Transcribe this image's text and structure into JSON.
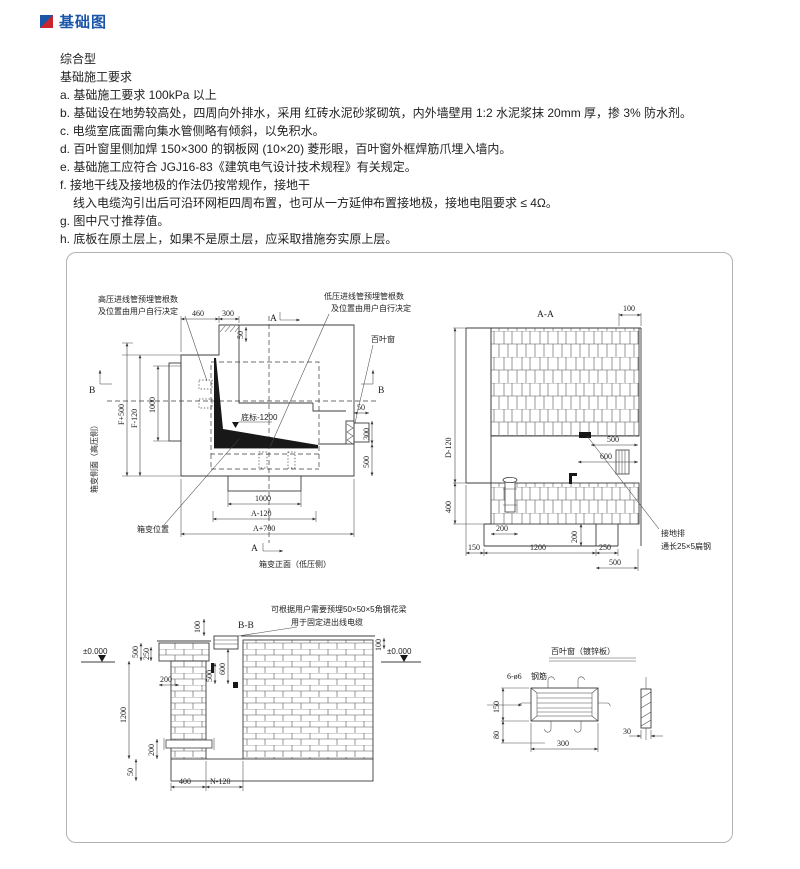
{
  "header": {
    "title": "基础图"
  },
  "colors": {
    "accent_blue": "#1b55a8",
    "accent_red": "#c8252c"
  },
  "notes": {
    "type_label": "综合型",
    "section_title": "基础施工要求",
    "items": [
      "a. 基础施工要求 100kPa 以上",
      "b. 基础设在地势较高处，四周向外排水，采用 红砖水泥砂浆砌筑，内外墙壁用 1:2 水泥浆抹 20mm 厚，掺 3% 防水剂。",
      "c. 电缆室底面需向集水管侧略有倾斜，以免积水。",
      "d. 百叶窗里侧加焊 150×300 的钢板网 (10×20) 菱形眼，百叶窗外框焊筋爪埋入墙内。",
      "e. 基础施工应符合 JGJ16-83《建筑电气设计技术规程》有关规定。",
      "f. 接地干线及接地极的作法仍按常规作，接地干",
      "线入电缆沟引出后可沿环网柜四周布置，也可从一方延伸布置接地极，接地电阻要求 ≤ 4Ω。",
      "g. 图中尺寸推荐值。",
      "h. 底板在原土层上，如果不是原土层，应采取措施夯实原上层。"
    ]
  },
  "drawing": {
    "plan": {
      "callout_hv_line1": "高压进线管预埋管根数",
      "callout_hv_line2": "及位置由用户自行决定",
      "callout_lv_line1": "低压进线管预埋管根数",
      "callout_lv_line2": "及位置由用户自行决定",
      "louver_label": "百叶窗",
      "dim_460": "460",
      "dim_300_top": "300",
      "dim_50_top": "50",
      "mark_a_top": "A",
      "mark_a_bottom": "A",
      "mark_b_left": "B",
      "mark_b_right": "B",
      "dim_f_plus_500": "F+500",
      "dim_f_minus_120": "F-120",
      "dim_1000_left": "1000",
      "level_label": "底标-1200",
      "dim_50_right": "50",
      "dim_300_right": "300",
      "dim_500_right": "500",
      "dim_1000_bottom": "1000",
      "dim_a_minus_120": "A-120",
      "dim_a_plus_700": "A+700",
      "label_side": "箱变侧面（高压侧）",
      "label_front": "箱变正面（低压侧）",
      "label_position": "箱变位置"
    },
    "section_aa": {
      "title": "A-A",
      "dim_100": "100",
      "dim_500_mid": "500",
      "dim_600": "600",
      "dim_d_minus_120": "D-120",
      "dim_400": "400",
      "dim_200_left": "200",
      "dim_200_right": "200",
      "dim_150": "150",
      "dim_1200": "1200",
      "dim_250": "250",
      "dim_500_bottom": "500",
      "callout_ground_line1": "接地排",
      "callout_ground_line2": "通长25×5扁钢"
    },
    "section_bb": {
      "title": "B-B",
      "callout_line1": "可根据用户需要预埋50×50×5角钢花梁",
      "callout_line2": "用于固定进出线电缆",
      "level_left": "±0.000",
      "level_right": "±0.000",
      "dim_100_left": "100",
      "dim_500_left": "500",
      "dim_250": "250",
      "dim_200_wall": "200",
      "dim_1200": "1200",
      "dim_200_pipe": "200",
      "dim_50": "50",
      "dim_600": "600",
      "dim_500_center": "500",
      "dim_100_right": "100",
      "dim_400": "400",
      "dim_n_minus_120": "N-120"
    },
    "louver_detail": {
      "title": "百叶窗（镀锌板）",
      "label_rebar_count": "6-ø6",
      "label_rebar": "钢筋",
      "dim_150": "150",
      "dim_80": "80",
      "dim_300": "300",
      "dim_30": "30"
    }
  }
}
